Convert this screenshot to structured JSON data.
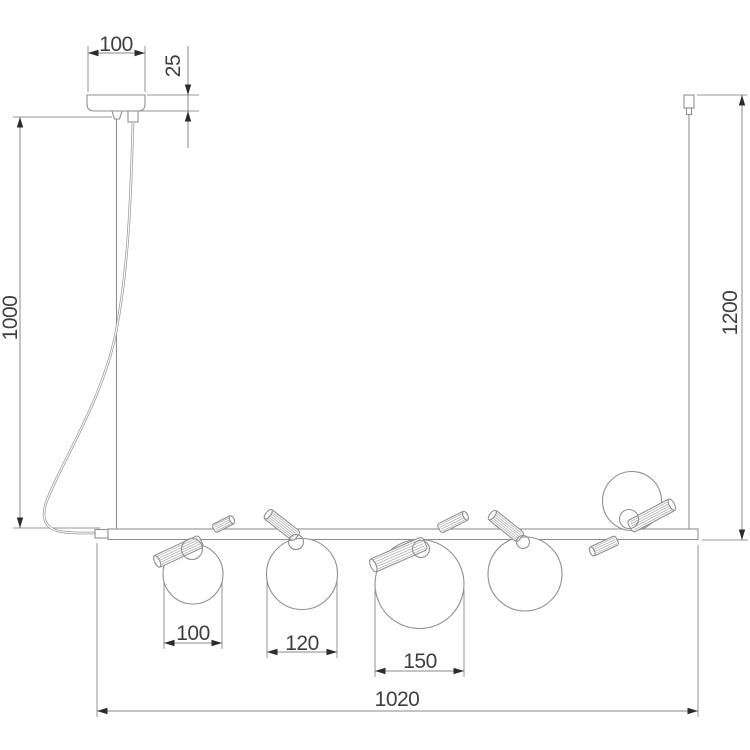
{
  "page": {
    "background": "#ffffff"
  },
  "colors": {
    "line": "#8f8f8f",
    "text": "#3f3f3f",
    "arrow": "#2b2b2b"
  },
  "dimensions": {
    "canopy_width": "100",
    "canopy_height": "25",
    "drop_left": "1000",
    "drop_right": "1200",
    "globe1_diameter": "100",
    "globe2_diameter": "120",
    "globe3_diameter": "150",
    "bar_length": "1020"
  }
}
